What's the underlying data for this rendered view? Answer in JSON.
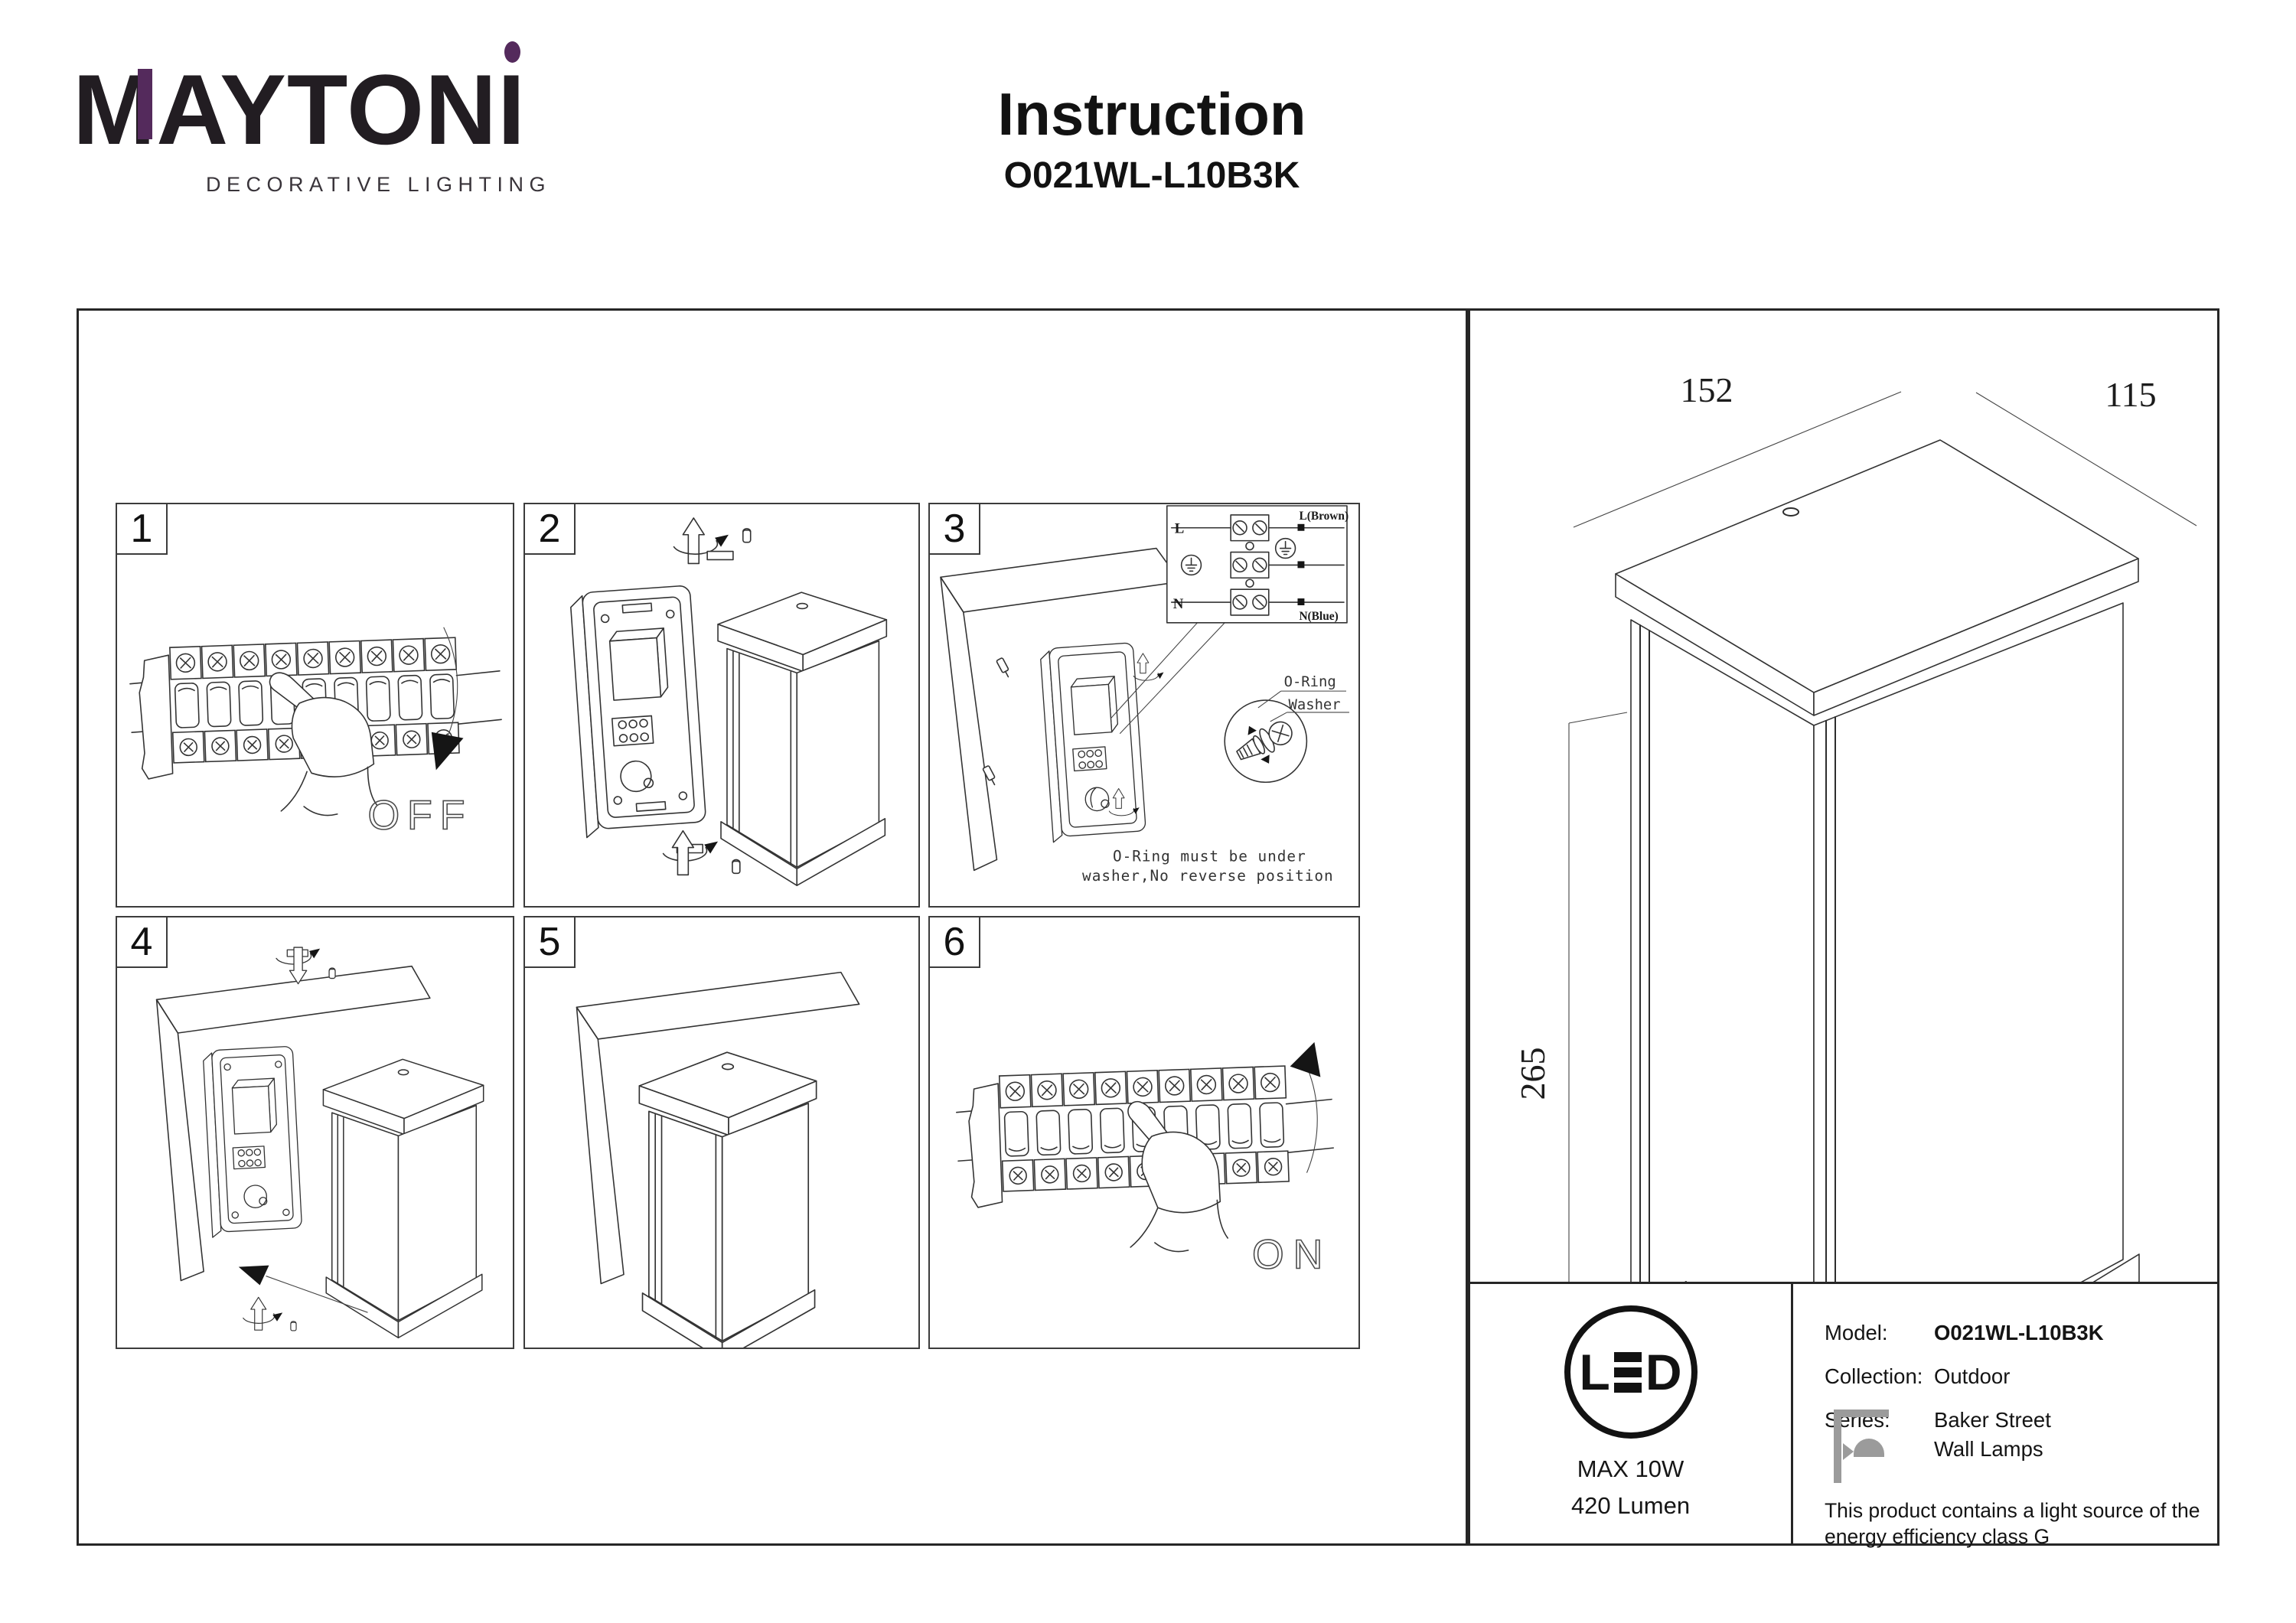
{
  "brand": {
    "name": "MAYTONI",
    "tagline": "DECORATIVE LIGHTING",
    "accent_color": "#542a5c"
  },
  "doc": {
    "title": "Instruction",
    "model": "O021WL-L10B3K"
  },
  "steps": [
    {
      "number": "1",
      "label": "OFF"
    },
    {
      "number": "2"
    },
    {
      "number": "3",
      "wiring": {
        "live": "L",
        "neutral": "N",
        "live_wire": "L(Brown)",
        "neutral_wire": "N(Blue)"
      },
      "detail": {
        "oring": "O-Ring",
        "washer": "Washer",
        "note1": "O-Ring must be under",
        "note2": "washer,No reverse position"
      }
    },
    {
      "number": "4"
    },
    {
      "number": "5"
    },
    {
      "number": "6",
      "label": "ON"
    }
  ],
  "dimensions": {
    "width_mm": "152",
    "depth_mm": "115",
    "height_mm": "265"
  },
  "lamp_spec": {
    "source_l": "L",
    "source_d": "D",
    "max_power": "MAX 10W",
    "flux": "420 Lumen"
  },
  "product": {
    "model_label": "Model:",
    "model_value": "O021WL-L10B3K",
    "collection_label": "Collection:",
    "collection_value": "Outdoor",
    "series_label": "Series:",
    "series_value": "Baker Street",
    "type_value": "Wall Lamps",
    "energy_note": "This product contains a light source of the energy efficiency class G"
  }
}
